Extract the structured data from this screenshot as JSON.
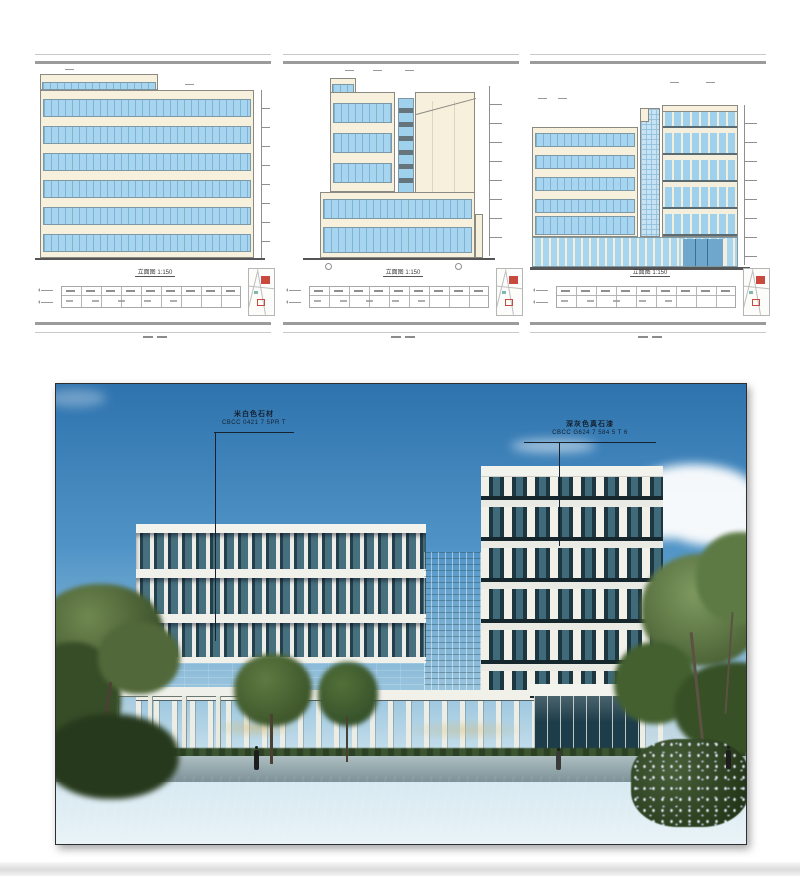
{
  "panels": [
    {
      "name": "elevation-1",
      "caption": "立面图 1:150"
    },
    {
      "name": "elevation-2",
      "caption": "立面图 1:150"
    },
    {
      "name": "elevation-3",
      "caption": "立面图 1:150"
    }
  ],
  "rendering": {
    "annotations": {
      "left": {
        "label": "米白色石材",
        "code": "CBCC 0421 7 5PR T"
      },
      "right": {
        "label": "深灰色真石漆",
        "code": "CBCC G624 7 584 5 T 6"
      }
    }
  },
  "colors": {
    "drawing_glass": "#a7d5ef",
    "drawing_wall": "#f6f0dc",
    "keymap_highlight": "#c9493f",
    "sky_top": "#2f73ae",
    "sky_horizon": "#d5e8f1",
    "glass_dark": "#1d3640",
    "glass_teal": "#47707e",
    "pier_white": "#f1f1ea",
    "foliage_dark": "#33491f",
    "foliage_light": "#6c8a50",
    "lawn": "#55713a"
  }
}
